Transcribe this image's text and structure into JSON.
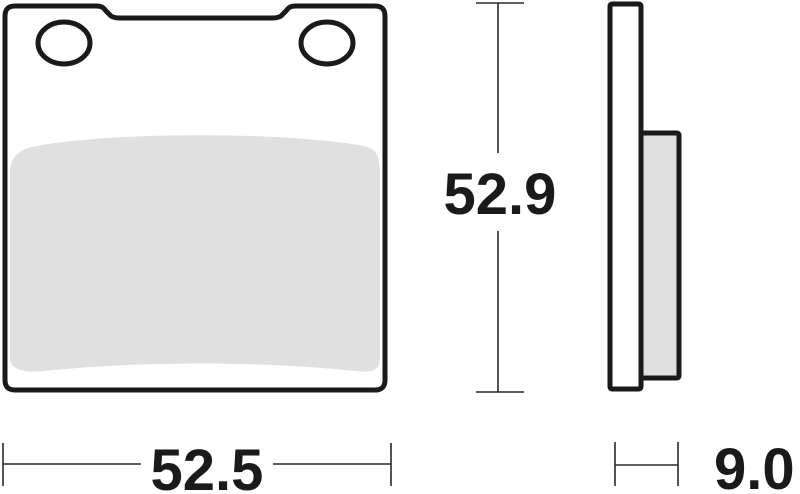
{
  "drawing": {
    "subject": "brake-pad-technical-drawing",
    "dimensions": {
      "width_label": "52.5",
      "height_label": "52.9",
      "thickness_label": "9.0"
    },
    "colors": {
      "line": "#1a1a1a",
      "dimension_line": "#2a2a2a",
      "friction_fill": "#e0e0e0",
      "plate_fill": "#ffffff",
      "background": "#ffffff"
    }
  }
}
